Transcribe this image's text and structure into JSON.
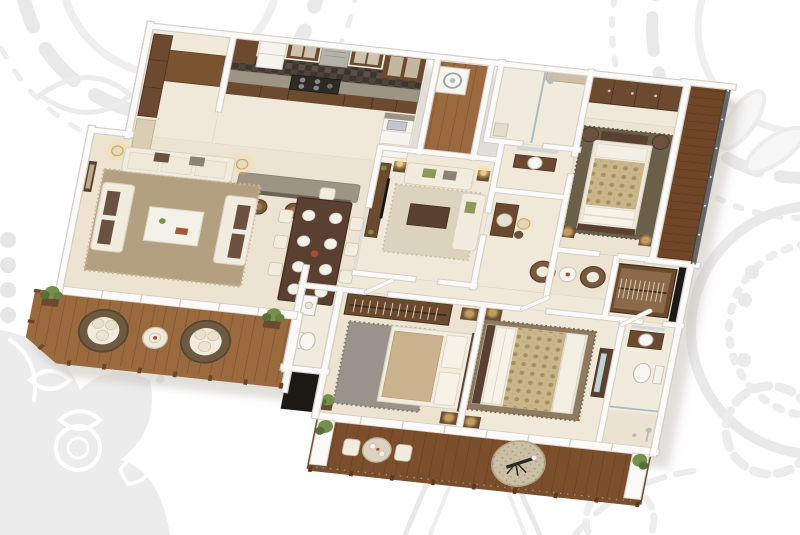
{
  "scene": {
    "type": "3d-floorplan-render",
    "description": "Isometric 3D rendering of a 3-bedroom apartment floor plan, viewed from above at a slight tilt, on a white background decorated with faint gray mandala doodle patterns. No text labels are rendered.",
    "visible_text": []
  },
  "palette": {
    "bg": "#ffffff",
    "patternG": "#e9e9e9",
    "patternF": "#ececec",
    "wall": "#fbfaf8",
    "wallEdge": "#d4cfc7",
    "floor": "#ece3d1",
    "floorWarm": "#f0e9d9",
    "marble": "#f0ebdd",
    "woodLeft": "#9a6a3e",
    "woodBottom": "#7c4f2c",
    "woodRight": "#6e4527",
    "furnDark": "#5a4030",
    "wardrobe": "#6b4a30",
    "sofa": "#f2ecdf",
    "sofaEdge": "#d9d1c0",
    "cushion": "#6b5140",
    "olive": "#8d9a55",
    "rugLiving": "#b3a081",
    "rugLounge": "#dcd3be",
    "rugGray": "#99938b",
    "rugBed": "#8d7a5f",
    "rugMaster": "#6a6049",
    "damask": "#c9b68b",
    "damaskDot": "#a8905f",
    "granite": "#9d9483",
    "tileDark": "#4e443a",
    "tileDark2": "#3e362e",
    "lamp": "#f2d9a2",
    "plant": "#76904c",
    "rail": "#4a3426",
    "glass": "#3c3e40",
    "steel": "#b9bcbe",
    "accentRed": "#b0492f",
    "white": "#f6f4ef",
    "black": "#1c1915",
    "shadow": "#c5c0b6"
  },
  "rooms": [
    {
      "id": "entry-foyer",
      "label": "Entry Foyer",
      "features": [
        "coat-wardrobe",
        "wood-floor-mat"
      ]
    },
    {
      "id": "kitchen",
      "label": "Kitchen",
      "features": [
        "glass-upper-cabinets",
        "chimney-hood",
        "cooktop",
        "refrigerator",
        "dark-checker-tile-floor",
        "breakfast-island",
        "three-bar-stools",
        "peninsula-drawer-unit"
      ]
    },
    {
      "id": "utility-balcony",
      "label": "Utility Balcony",
      "features": [
        "washing-machine",
        "wood-deck",
        "dark-railing"
      ]
    },
    {
      "id": "living-room",
      "label": "Living Room",
      "features": [
        "three-cream-sofas",
        "white-coffee-table",
        "shag-rug",
        "two-floor-lamps",
        "wall-art"
      ]
    },
    {
      "id": "dining-area",
      "label": "Dining Area",
      "features": [
        "dark-wood-table",
        "eight-place-settings",
        "cream-chairs"
      ]
    },
    {
      "id": "family-lounge",
      "label": "Family Lounge",
      "features": [
        "tv-sideboard",
        "two-sofas",
        "coffee-table",
        "rug",
        "two-table-lamps"
      ]
    },
    {
      "id": "passage",
      "label": "Passage",
      "features": [
        "pendant-lamp",
        "powder-basin",
        "vanity-console"
      ]
    },
    {
      "id": "master-bathroom",
      "label": "Master Bathroom",
      "features": [
        "glass-shower",
        "marble-floor"
      ]
    },
    {
      "id": "master-bedroom",
      "label": "Master Bedroom",
      "features": [
        "damask-double-bed",
        "foot-bench",
        "two-nightstands",
        "two-armchairs",
        "sliding-wardrobe",
        "dark-rug"
      ]
    },
    {
      "id": "side-balcony",
      "label": "Side Balcony",
      "features": [
        "wood-deck",
        "dark-glass-railing"
      ]
    },
    {
      "id": "sitting-nook",
      "label": "Sitting Nook",
      "features": [
        "two-swivel-chairs",
        "round-table"
      ]
    },
    {
      "id": "walk-in-closet",
      "label": "Walk-in Closet",
      "features": [
        "open-hanging-rail",
        "dark-glass-panel"
      ]
    },
    {
      "id": "bedroom-2",
      "label": "Bedroom 2",
      "features": [
        "open-closet",
        "double-bed",
        "gray-shag-rug",
        "two-nightstands",
        "potted-plant"
      ]
    },
    {
      "id": "bedroom-3",
      "label": "Bedroom 3",
      "features": [
        "damask-double-bed",
        "brown-shag-rug",
        "two-nightstands",
        "dresser-with-mirror"
      ]
    },
    {
      "id": "bathroom-2",
      "label": "Bathroom",
      "features": [
        "round-basin-vanity",
        "toilet",
        "shower-fixtures",
        "shower-stall"
      ]
    },
    {
      "id": "powder-room",
      "label": "Powder Room",
      "features": [
        "washbasin",
        "toilet"
      ]
    },
    {
      "id": "left-balcony",
      "label": "Left Balcony",
      "features": [
        "two-round-rattan-loungers",
        "round-side-table",
        "wood-deck",
        "railing",
        "potted-plants"
      ]
    },
    {
      "id": "bottom-balcony",
      "label": "Bottom Balcony",
      "features": [
        "bistro-table",
        "two-chairs",
        "round-jute-rug",
        "telescope",
        "wood-deck",
        "railing",
        "potted-plants"
      ]
    }
  ],
  "background": {
    "style": "white field with faint light-gray hand-drawn mandala / paisley doodles in the corners and lower half"
  }
}
